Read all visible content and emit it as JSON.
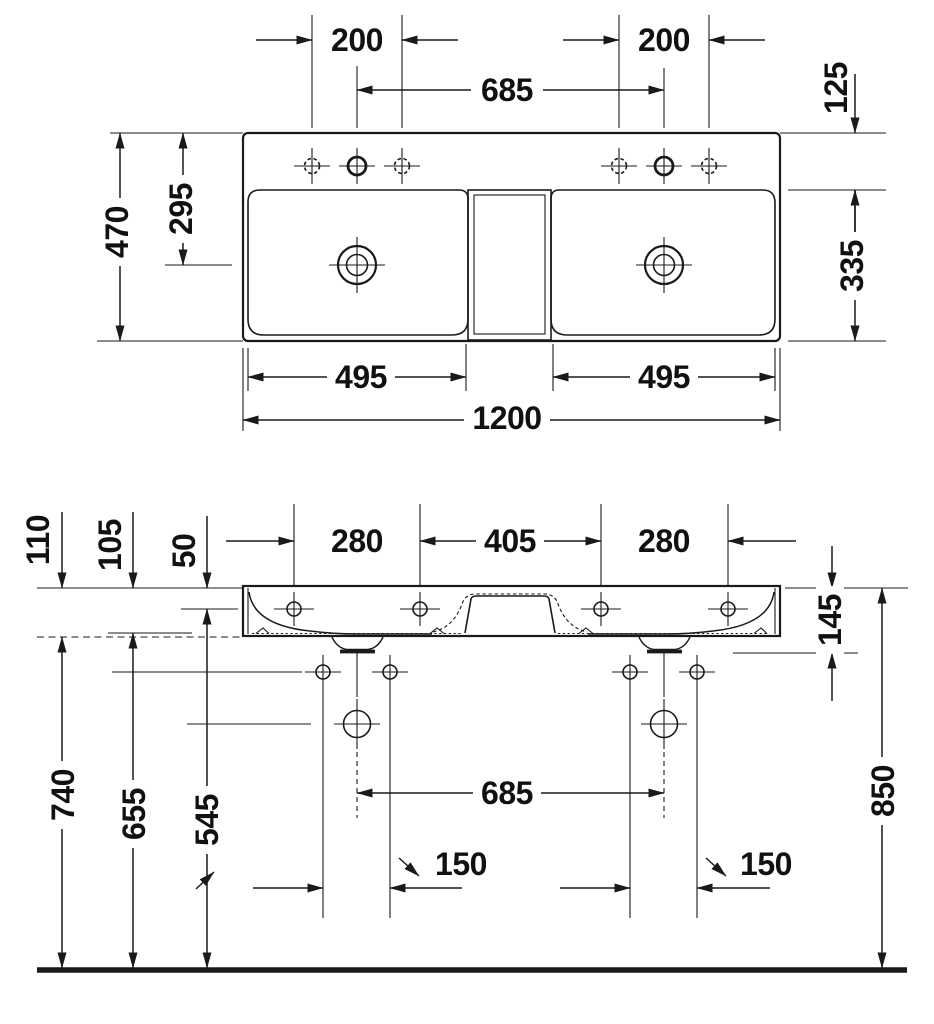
{
  "page": {
    "background": "#ffffff",
    "line_color": "#1a1a1a"
  },
  "plan_view": {
    "name": "plan view of double washbasin",
    "dims": {
      "tap_holes_left": "200",
      "tap_holes_right": "200",
      "tap_centers": "685",
      "ledge_depth": "125",
      "total_depth": "470",
      "drain_setback": "295",
      "basin_depth": "335",
      "basin_width_left": "495",
      "basin_width_right": "495",
      "total_width": "1200"
    }
  },
  "front_view": {
    "name": "front elevation of double washbasin",
    "dims": {
      "rim_to_underside_outer": "110",
      "rim_to_underside": "105",
      "rim_to_fixing": "50",
      "fixing_span_left": "280",
      "fixing_span_center": "405",
      "fixing_span_right": "280",
      "rim_to_outlet": "145",
      "floor_to_underside": "740",
      "floor_to_fixing_bolts": "655",
      "floor_to_drain": "545",
      "drain_centers": "685",
      "bolt_pair_left": "150",
      "bolt_pair_right": "150",
      "floor_to_rim": "850"
    }
  }
}
